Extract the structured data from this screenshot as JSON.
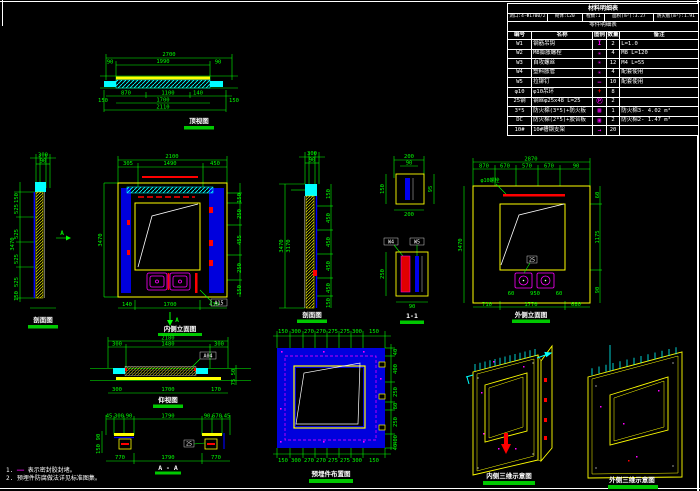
{
  "colors": {
    "green": "#00ff00",
    "cyan": "#00ffff",
    "yellow": "#ffff00",
    "blue": "#0000dd",
    "magenta": "#ff00ff",
    "red": "#ff0000",
    "white": "#ffffff"
  },
  "table": {
    "title": "材料明细表",
    "params": [
      "洞口:4-Φ1700/2",
      "砌体:C20",
      "樘数:1",
      "面积(m²):3.27",
      "防火板(m²):1.91"
    ],
    "subtitle": "零件明细表",
    "headers": [
      "编号",
      "名称",
      "图例",
      "数量",
      "备注"
    ],
    "rows": [
      {
        "id": "W1",
        "name": "钢筋吊钩",
        "symbol": "I",
        "color": "#ff00ff",
        "qty": "2",
        "note": "L=1.0"
      },
      {
        "id": "W2",
        "name": "M8膨胀螺栓",
        "symbol": "✳",
        "color": "#ff00ff",
        "qty": "4",
        "note": "M8 L=120"
      },
      {
        "id": "W3",
        "name": "自攻螺丝",
        "symbol": "✳",
        "color": "#ff00ff",
        "qty": "12",
        "note": "M4 L=55"
      },
      {
        "id": "W4",
        "name": "塑料胀管",
        "symbol": "✳",
        "color": "#ff00ff",
        "qty": "4",
        "note": "配套使用"
      },
      {
        "id": "W5",
        "name": "拉铆钉",
        "symbol": "—",
        "color": "#ff00ff",
        "qty": "10",
        "note": "配套使用"
      },
      {
        "id": "φ10",
        "name": "φ10吊环",
        "symbol": "+",
        "color": "#ff0000",
        "qty": "8",
        "note": ""
      },
      {
        "id": "25钢",
        "name": "钢丝φ25x48 L=25",
        "symbol": "Ⓟ",
        "color": "#ff00ff",
        "qty": "2",
        "note": ""
      },
      {
        "id": "3*5",
        "name": "防火棉(3*5)+防火板",
        "symbol": "▦",
        "color": "#ff00ff",
        "qty": "1",
        "note": "防火棉3- 4.02 m²"
      },
      {
        "id": "DC",
        "name": "防火棉(2*5)+胶合板",
        "symbol": "▣",
        "color": "#ff00ff",
        "qty": "2",
        "note": "防火棉2- 1.47 m²"
      },
      {
        "id": "10#",
        "name": "10#槽钢支架",
        "symbol": "→",
        "color": "#ff00ff",
        "qty": "20",
        "note": ""
      }
    ]
  },
  "views": {
    "top_view": {
      "label": "顶视图",
      "dims": [
        "2700",
        "1990",
        "90",
        "90",
        "870",
        "1100",
        "140",
        "1700",
        "2110",
        "150",
        "150"
      ]
    },
    "left_section": {
      "label": "剖面图",
      "marker": "A",
      "dims": [
        "300",
        "90",
        "150",
        "525",
        "525",
        "525",
        "525",
        "150",
        "3470"
      ]
    },
    "main_elevation": {
      "label": "内侧立面图",
      "marker": "A",
      "callout": "A15",
      "dims": [
        "2100",
        "305",
        "1490",
        "450",
        "150",
        "250",
        "455",
        "250",
        "150",
        "140",
        "1700",
        "430",
        "3470"
      ]
    },
    "mid_section": {
      "label": "剖面图",
      "dims": [
        "300",
        "90",
        "3470",
        "3170",
        "150",
        "450",
        "450",
        "450",
        "450",
        "150"
      ]
    },
    "small_details": {
      "label": "1-1",
      "callouts": [
        "W4",
        "W5"
      ],
      "dims": [
        "200",
        "90",
        "150",
        "95",
        "200",
        "250",
        "90"
      ]
    },
    "right_elevation": {
      "label": "外侧立面图",
      "leader": "φ10螺栓",
      "leader2": "25",
      "dims": [
        "2870",
        "870",
        "670",
        "570",
        "670",
        "90",
        "3470",
        "60",
        "1175",
        "90",
        "60",
        "950",
        "60",
        "710",
        "1770",
        "680"
      ]
    },
    "bottom_section1": {
      "label": "仰视图",
      "callout": "A04",
      "dims": [
        "2180",
        "300",
        "1480",
        "300",
        "300",
        "1700",
        "170",
        "50",
        "75"
      ]
    },
    "bottom_section2": {
      "label": "A - A",
      "leader": "25",
      "dims": [
        "45",
        "300",
        "90",
        "1790",
        "90",
        "670",
        "45",
        "770",
        "1790",
        "770",
        "90",
        "150"
      ]
    },
    "bottom_plan": {
      "label": "预埋件布置图",
      "top_dims": [
        "150",
        "300",
        "270",
        "270",
        "275",
        "275",
        "300",
        "150"
      ],
      "bottom_dims": [
        "150",
        "300",
        "270",
        "270",
        "275",
        "275",
        "300",
        "150"
      ],
      "right_dims": [
        "40",
        "400",
        "250",
        "80",
        "250",
        "400",
        "40"
      ]
    },
    "iso_left": {
      "label": "内侧三维示意图"
    },
    "iso_right": {
      "label": "外侧三维示意图"
    }
  },
  "notes": {
    "n1": "1.",
    "dash": "——",
    "t1": "表示密封胶封堵。",
    "t2": "2. 预埋件防腐做法详见标准图集。"
  }
}
